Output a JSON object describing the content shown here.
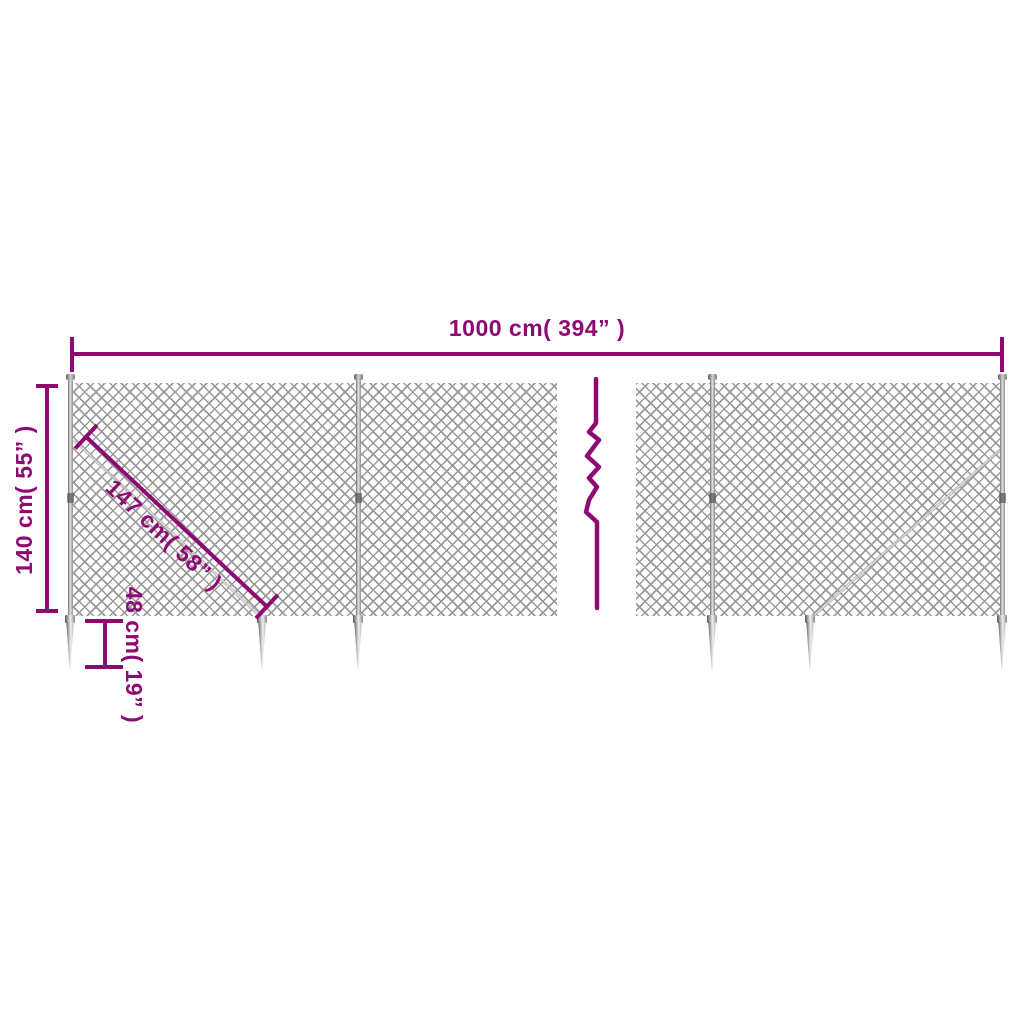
{
  "diagram": {
    "colors": {
      "accent": "#8e0a73",
      "mesh_gray": "#848484",
      "metal_light": "#e2e2e2",
      "metal_dark": "#555555",
      "background": "#ffffff"
    },
    "dimensions": {
      "width": "1000 cm( 394” )",
      "height": "140 cm( 55” )",
      "diagonal": "147 cm( 58” )",
      "anchor": "48 cm( 19” )"
    }
  }
}
